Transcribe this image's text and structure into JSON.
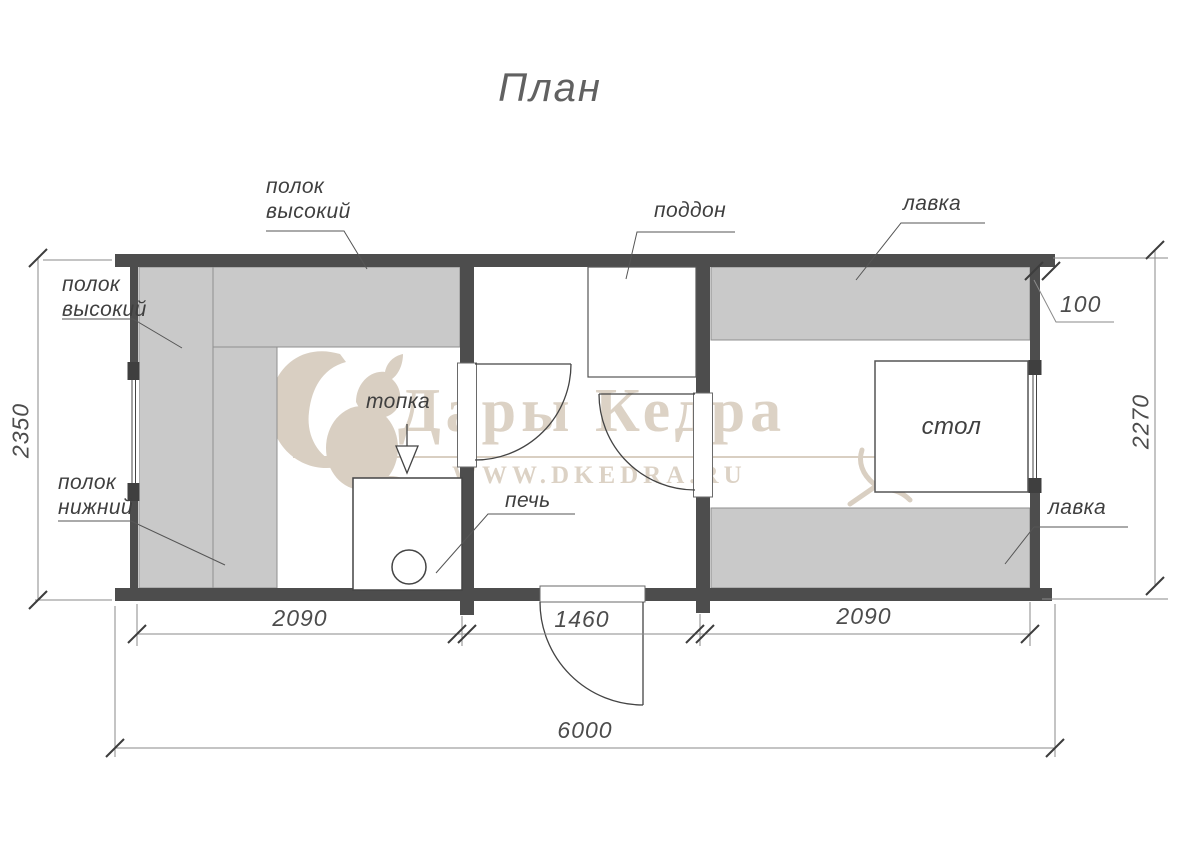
{
  "title": "План",
  "watermark": {
    "brand": "Дары Кедра",
    "site": "WWW.DKEDRA.RU",
    "color": "#dcd2c5"
  },
  "labels": {
    "shelf_high_top": {
      "line1": "полок",
      "line2": "высокий"
    },
    "shelf_high_left": {
      "line1": "полок",
      "line2": "высокий"
    },
    "shelf_low_left": {
      "line1": "полок",
      "line2": "нижний"
    },
    "pallet": "поддон",
    "bench_top": "лавка",
    "bench_bottom": "лавка",
    "firebox": "топка",
    "stove": "печь",
    "table": "стол"
  },
  "dimensions": {
    "room_left_width": "2090",
    "room_middle_width": "1460",
    "room_right_width": "2090",
    "total_width": "6000",
    "height_left": "2350",
    "height_right": "2270",
    "wall_thickness": "100"
  },
  "colors": {
    "wall": "#4d4d4d",
    "bench_fill": "#c9c9c9",
    "line": "#555555",
    "watermark": "#dcd2c5"
  }
}
